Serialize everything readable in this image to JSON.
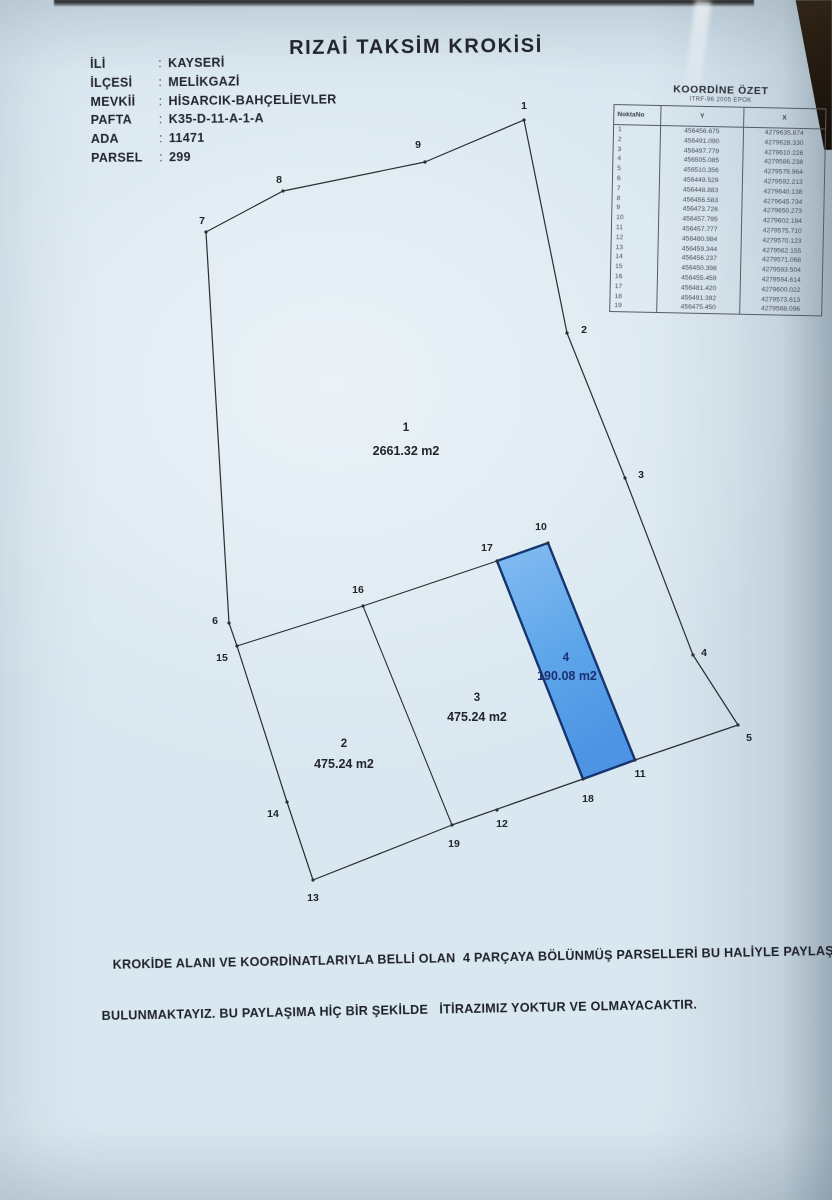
{
  "document": {
    "title": "RIZAİ TAKSİM KROKİSİ",
    "colon": ":",
    "info": [
      {
        "label": "İLİ",
        "value": "KAYSERİ"
      },
      {
        "label": "İLÇESİ",
        "value": "MELİKGAZİ"
      },
      {
        "label": "MEVKİİ",
        "value": "HİSARCIK-BAHÇELİEVLER"
      },
      {
        "label": "PAFTA",
        "value": "K35-D-11-A-1-A"
      },
      {
        "label": "ADA",
        "value": "11471"
      },
      {
        "label": "PARSEL",
        "value": "299"
      }
    ],
    "statement_line1": "KROKİDE ALANI VE KOORDİNATLARIYLA BELLİ OLAN  4 PARÇAYA BÖLÜNMÜŞ PARSELLERİ BU HALİYLE PAYLAŞMIŞ",
    "statement_line2": "BULUNMAKTAYIZ. BU PAYLAŞIMA HİÇ BİR ŞEKİLDE   İTİRAZIMIZ YOKTUR VE OLMAYACAKTIR."
  },
  "coordinate_table": {
    "title": "KOORDİNE ÖZET",
    "subtitle": "ITRF-96 2005 EPOK",
    "columns": [
      "NoktaNo",
      "Y",
      "X"
    ],
    "rows": [
      [
        "1",
        "456456.675",
        "4279635.874"
      ],
      [
        "2",
        "456491.090",
        "4279628.330"
      ],
      [
        "3",
        "456497.779",
        "4279610.226"
      ],
      [
        "4",
        "456505.085",
        "4279586.238"
      ],
      [
        "5",
        "456510.356",
        "4279579.964"
      ],
      [
        "6",
        "456449.529",
        "4279592.213"
      ],
      [
        "7",
        "456448.883",
        "4279640.138"
      ],
      [
        "8",
        "456456.583",
        "4279645.734"
      ],
      [
        "9",
        "456473.726",
        "4279650.273"
      ],
      [
        "10",
        "456457.795",
        "4279602.184"
      ],
      [
        "11",
        "456457.777",
        "4279575.710"
      ],
      [
        "12",
        "456480.984",
        "4279570.123"
      ],
      [
        "13",
        "456459.344",
        "4279562.155"
      ],
      [
        "14",
        "456456.237",
        "4279571.068"
      ],
      [
        "15",
        "456450.398",
        "4279583.504"
      ],
      [
        "16",
        "456455.459",
        "4279594.614"
      ],
      [
        "17",
        "456481.420",
        "4279600.022"
      ],
      [
        "18",
        "456491.392",
        "4279573.613"
      ],
      [
        "19",
        "456475.450",
        "4279568.096"
      ]
    ]
  },
  "sketch": {
    "colors": {
      "line": "#2b2c34",
      "parcel_fill_top": "#85bcf2",
      "parcel_fill_bottom": "#4d94e4",
      "parcel_stroke": "#15356e",
      "label": "#23242c",
      "navy_label": "#1c2e6f",
      "paper": "#d9e7f0"
    },
    "points": {
      "1": {
        "v": [
          524,
          120
        ],
        "l": [
          524,
          106
        ]
      },
      "2": {
        "v": [
          567,
          333
        ],
        "l": [
          584,
          330
        ]
      },
      "3": {
        "v": [
          625,
          478
        ],
        "l": [
          641,
          475
        ]
      },
      "4": {
        "v": [
          693,
          655
        ],
        "l": [
          704,
          653
        ]
      },
      "5": {
        "v": [
          738,
          725
        ],
        "l": [
          749,
          738
        ]
      },
      "6": {
        "v": [
          229,
          623
        ],
        "l": [
          215,
          621
        ]
      },
      "7": {
        "v": [
          206,
          232
        ],
        "l": [
          202,
          221
        ]
      },
      "8": {
        "v": [
          283,
          191
        ],
        "l": [
          279,
          180
        ]
      },
      "9": {
        "v": [
          425,
          162
        ],
        "l": [
          418,
          145
        ]
      },
      "10": {
        "v": [
          548,
          543
        ],
        "l": [
          541,
          527
        ]
      },
      "11": {
        "v": [
          635,
          760
        ],
        "l": [
          640,
          774
        ]
      },
      "12": {
        "v": [
          497,
          810
        ],
        "l": [
          502,
          824
        ]
      },
      "13": {
        "v": [
          313,
          880
        ],
        "l": [
          313,
          898
        ]
      },
      "14": {
        "v": [
          287,
          802
        ],
        "l": [
          273,
          814
        ]
      },
      "15": {
        "v": [
          237,
          646
        ],
        "l": [
          222,
          658
        ]
      },
      "16": {
        "v": [
          363,
          606
        ],
        "l": [
          358,
          590
        ]
      },
      "17": {
        "v": [
          497,
          561
        ],
        "l": [
          487,
          548
        ]
      },
      "18": {
        "v": [
          583,
          779
        ],
        "l": [
          588,
          799
        ]
      },
      "19": {
        "v": [
          452,
          825
        ],
        "l": [
          454,
          844
        ]
      }
    },
    "outer_boundary": [
      "1",
      "2",
      "3",
      "4",
      "5",
      "11",
      "18",
      "19",
      "13",
      "14",
      "15",
      "6",
      "7",
      "8",
      "9"
    ],
    "interior_lines": [
      [
        "15",
        "16"
      ],
      [
        "16",
        "17"
      ],
      [
        "16",
        "19"
      ]
    ],
    "parcel4_polygon": [
      "17",
      "10",
      "11",
      "18"
    ],
    "parcels": [
      {
        "num": "1",
        "area": "2661.32 m2",
        "num_xy": [
          406,
          431
        ],
        "area_xy": [
          406,
          455
        ],
        "color": "#23242c"
      },
      {
        "num": "2",
        "area": "475.24 m2",
        "num_xy": [
          344,
          747
        ],
        "area_xy": [
          344,
          768
        ],
        "color": "#23242c"
      },
      {
        "num": "3",
        "area": "475.24 m2",
        "num_xy": [
          477,
          701
        ],
        "area_xy": [
          477,
          721
        ],
        "color": "#23242c"
      },
      {
        "num": "4",
        "area": "190.08 m2",
        "num_xy": [
          566,
          661
        ],
        "area_xy": [
          567,
          680
        ],
        "color": "#1c2e6f"
      }
    ]
  }
}
